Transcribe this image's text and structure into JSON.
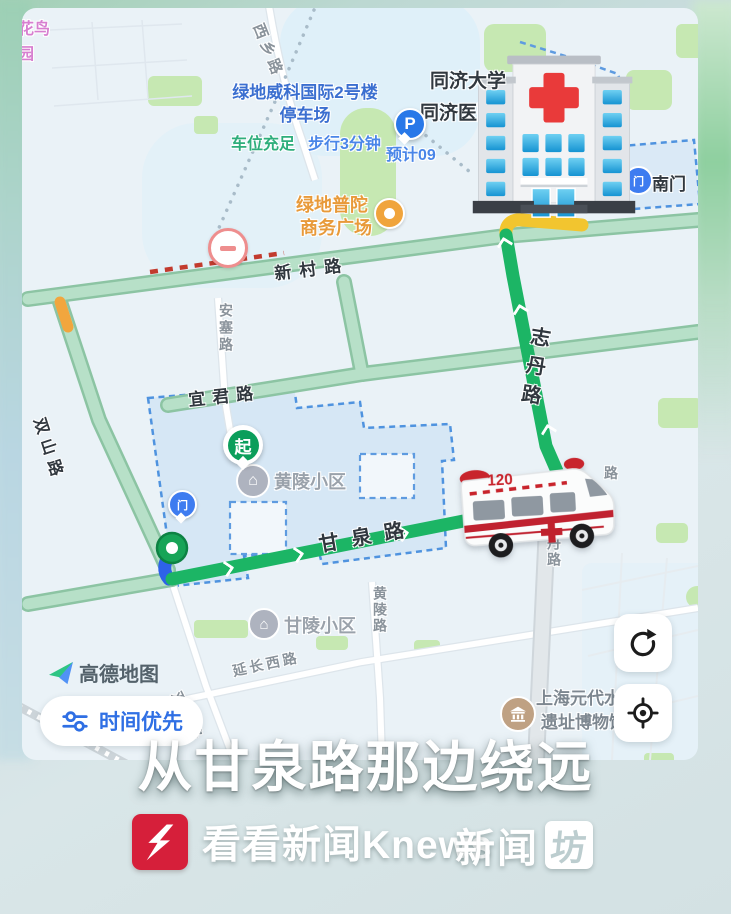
{
  "colors": {
    "route_green": "#1cb565",
    "route_slow_yellow": "#f2c52f",
    "route_walk_blue": "#2e62e8",
    "road_pale_green": "#b7e0c8",
    "accent_blue": "#2f6fe4",
    "knews_red": "#d61f3a"
  },
  "map": {
    "watermark": "高德地图",
    "area_huaniao": {
      "line1": "花鸟",
      "line2": "园"
    },
    "parking": {
      "name_line1": "绿地威科国际2号楼",
      "name_line2": "停车场",
      "status": "车位充足",
      "walk": "步行3分钟",
      "eta_partial": "预计09",
      "marker_letter": "P"
    },
    "hospital": {
      "line1": "同济大学",
      "line2": "同济医院"
    },
    "plaza": {
      "line1": "绿地普陀",
      "line2": "商务广场"
    },
    "gate_south": "南门",
    "gate_glyph": "门",
    "roads": {
      "xinchun": "新村路",
      "xixiang": "西乡路",
      "ansai": "安塞路",
      "yijun": "宜君路",
      "shuangshan": "双山路",
      "ganquan": "甘泉路",
      "zhidan": "志丹路",
      "zhidan_fragment": "路",
      "huangling_rd": "黄陵路",
      "yanchang": "延长西路"
    },
    "compounds": {
      "huangling": "黄陵小区",
      "ganling": "甘陵小区"
    },
    "museum": {
      "line1": "上海元代水闸",
      "line2": "遗址博物馆"
    },
    "route": {
      "start_label": "起"
    },
    "ambulance": {
      "number": "120"
    },
    "controls": {
      "route_pref": "时间优先"
    }
  },
  "caption": "从甘泉路那边绕远",
  "footer": {
    "knews": "看看新闻Knews",
    "brand2_text": "新闻",
    "brand2_box": "坊"
  }
}
